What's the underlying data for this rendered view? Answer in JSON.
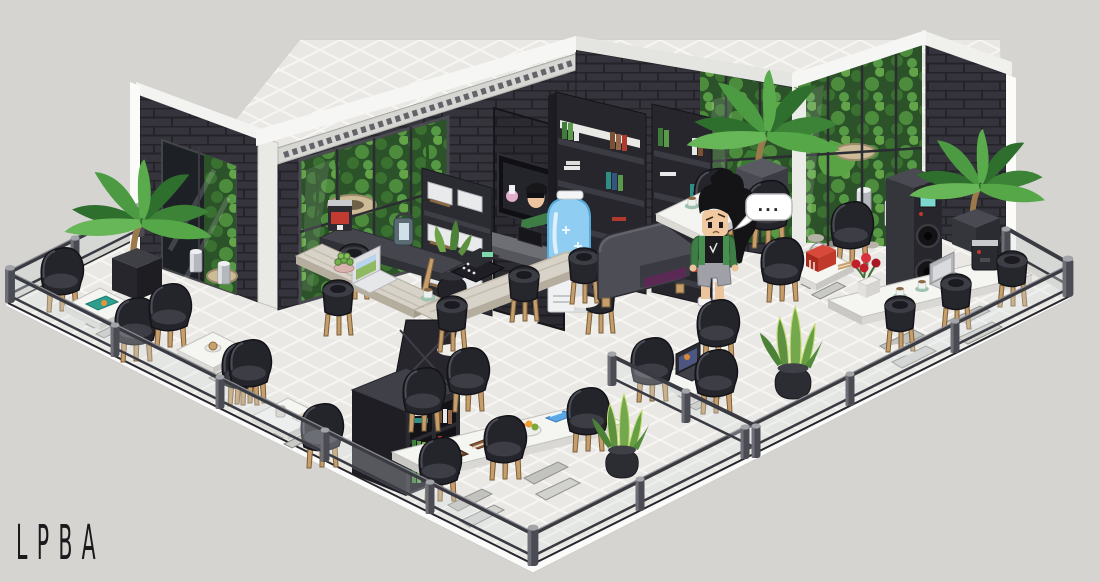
{
  "watermark": {
    "text": "LPBA"
  },
  "avatar": {
    "speech_bubble": "...",
    "description": "person with bushy black hair, green open jacket, black tee, gray shorts, white sneakers"
  },
  "palette": {
    "background": "#d5d4d0",
    "wall_brick": "#35343c",
    "brick_line": "#24232a",
    "wall_cap_white": "#f3f3f1",
    "floor_tile": "#e9e8e4",
    "tile_grout": "#f7f6f3",
    "platform_white": "#fbfbfa",
    "garden_green": "#2b5228",
    "garden_green_light": "#4c8c3c",
    "chair_black": "#24242b",
    "wood_leg": "#c59e6b",
    "table_white": "#f5f5f2",
    "sofa_gray": "#4c4d55",
    "sofa_accent_purple": "#5a2a54",
    "water_cooler_blue": "#8fcdf2",
    "jacket_green": "#3e7d46",
    "rose_red": "#c0202c",
    "takeout_box_red": "#c23a2c",
    "magazine_teal": "#2e9e8f",
    "book_blue": "#5aa7e8",
    "speech_bubble": "#ffffff",
    "watermark_ink": "#1a1a1c"
  },
  "scene": {
    "objects": [
      "dark-brick-walls",
      "white-roofline",
      "meander-frieze",
      "entrance-glass-doors",
      "indoor-garden-windows",
      "glass-garden-wall",
      "wall-tv-portrait",
      "espresso-machine-shelf",
      "tall-bookshelf-1",
      "tall-bookshelf-2",
      "cube-bookshelf",
      "water-cooler",
      "gray-sofa",
      "white-coffee-table",
      "big-plank-table",
      "white-laptop",
      "cash-register",
      "succulent-bowl",
      "small-cafe-tables",
      "long-table-bottom",
      "long-table-right",
      "black-bucket-chairs",
      "bar-stools",
      "teal-magazine",
      "coffee-cups",
      "fruit-bowl",
      "brown-books",
      "blue-book",
      "red-takeout-box",
      "rose-vase",
      "silver-laptop",
      "dark-laptop",
      "coffee-machine",
      "speaker-tower",
      "palm-plants",
      "snake-plants",
      "yucca-pot",
      "lantern",
      "trash-cans",
      "glass-railings",
      "railing-posts",
      "avatar",
      "speech-bubble"
    ]
  }
}
